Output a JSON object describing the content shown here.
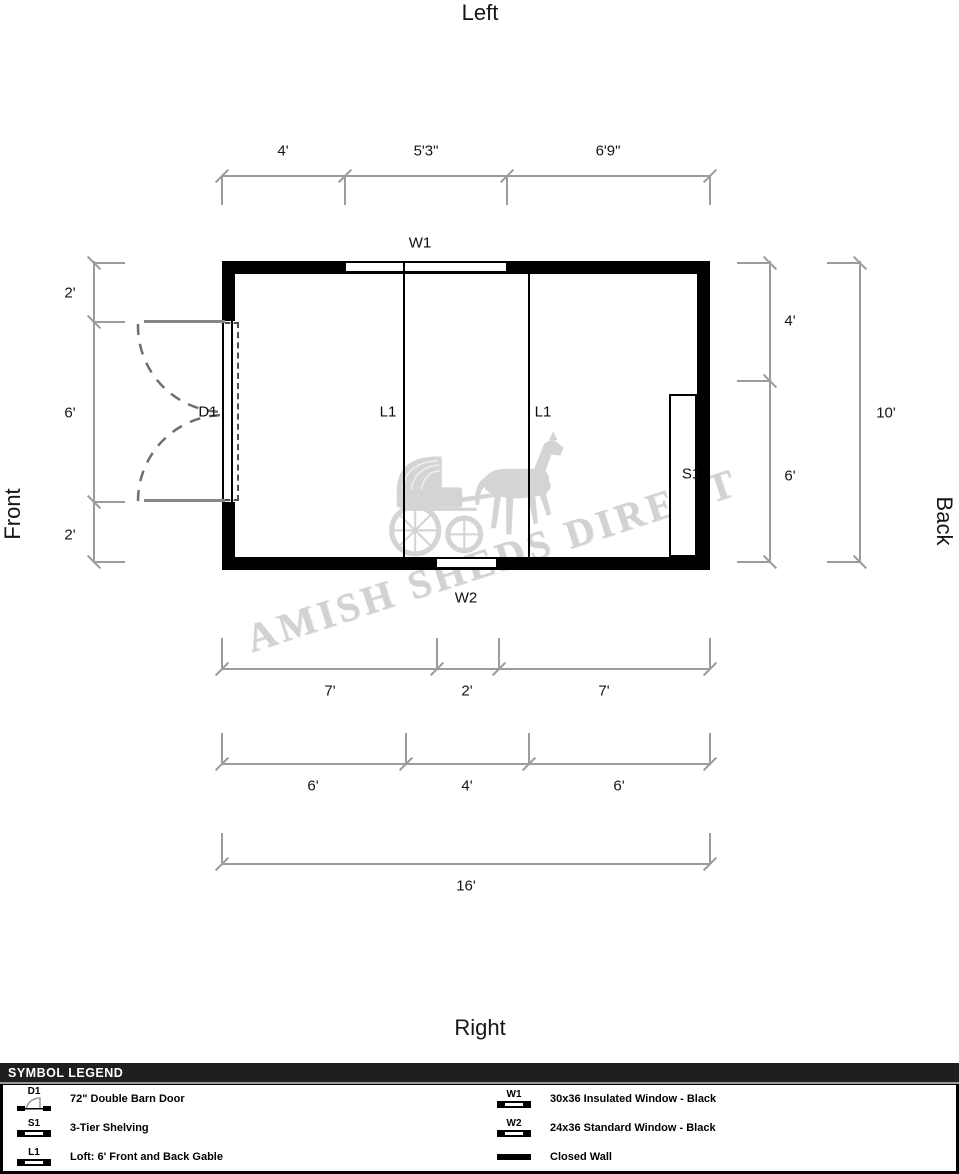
{
  "orientation": {
    "top": "Left",
    "bottom": "Right",
    "left": "Front",
    "right": "Back"
  },
  "watermark": {
    "text": "AMISH SHEDS DIRECT",
    "art": "horse-and-buggy-silhouette"
  },
  "plan": {
    "labels": {
      "w1": "W1",
      "w2": "W2",
      "d1": "D1",
      "s1": "S1",
      "l1_left": "L1",
      "l1_right": "L1"
    }
  },
  "dimensions": {
    "top": [
      "4'",
      "5'3\"",
      "6'9\""
    ],
    "left": [
      "2'",
      "6'",
      "2'"
    ],
    "right_inner": [
      "4'",
      "6'"
    ],
    "right_outer": "10'",
    "bottom_row1": [
      "7'",
      "2'",
      "7'"
    ],
    "bottom_row2": [
      "6'",
      "4'",
      "6'"
    ],
    "bottom_total": "16'"
  },
  "legend": {
    "header": "SYMBOL LEGEND",
    "left_items": [
      {
        "code": "D1",
        "desc": "72\" Double Barn Door"
      },
      {
        "code": "S1",
        "desc": "3-Tier Shelving"
      },
      {
        "code": "L1",
        "desc": "Loft: 6' Front and Back Gable"
      }
    ],
    "right_items": [
      {
        "code": "W1",
        "desc": "30x36 Insulated Window - Black"
      },
      {
        "code": "W2",
        "desc": "24x36 Standard Window - Black"
      },
      {
        "code": "",
        "desc": "Closed Wall"
      }
    ]
  },
  "colors": {
    "wall": "#000000",
    "dimension_line": "#9c9c9c",
    "door_swing": "#6f6f6f",
    "watermark": "#d2d2d2",
    "legend_header_bg": "#1f1f1f"
  }
}
